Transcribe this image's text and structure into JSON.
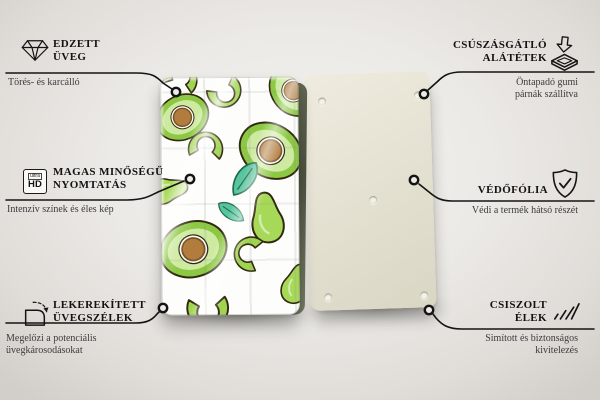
{
  "callouts": {
    "left": [
      {
        "icon": "diamond-icon",
        "title_lines": [
          "EDZETT",
          "ÜVEG"
        ],
        "subtitle_lines": [
          "Törés- és karcálló"
        ]
      },
      {
        "icon": "ultra-hd-icon",
        "icon_text_small": "ultra",
        "icon_text_big": "HD",
        "title_lines": [
          "MAGAS MINŐSÉGŰ",
          "NYOMTATÁS"
        ],
        "subtitle_lines": [
          "Intenzív színek és éles kép"
        ]
      },
      {
        "icon": "rounded-corner-icon",
        "title_lines": [
          "LEKEREKÍTETT",
          "ÜVEGSZÉLEK"
        ],
        "subtitle_lines": [
          "Megelőzi a potenciális",
          "üvegkárosodásokat"
        ]
      }
    ],
    "right": [
      {
        "icon": "anti-slip-pad-icon",
        "title_lines": [
          "CSÚSZÁSGÁTLÓ",
          "ALÁTÉTEK"
        ],
        "subtitle_lines": [
          "Öntapadó gumi",
          "párnák szállítva"
        ]
      },
      {
        "icon": "shield-check-icon",
        "title_lines": [
          "VÉDŐFÓLIA"
        ],
        "subtitle_lines": [
          "Védi a termék hátsó részét"
        ]
      },
      {
        "icon": "polished-edges-icon",
        "title_lines": [
          "CSISZOLT",
          "ÉLEK"
        ],
        "subtitle_lines": [
          "Simított és biztonságos",
          "kivitelezés"
        ]
      }
    ]
  },
  "product": {
    "front_board": "avocado-pattern-glass-board",
    "back_board": "plain-back-board-with-pads",
    "colors": {
      "avocado_rim_green": "#8cc843",
      "avocado_flesh": "#cdeaa0",
      "pit_brown": "#b17c3d",
      "leaf_teal": "#58c59c",
      "back_board_beige": "#dcd9c7",
      "callout_line": "#141414",
      "background": "#eceae6"
    }
  }
}
